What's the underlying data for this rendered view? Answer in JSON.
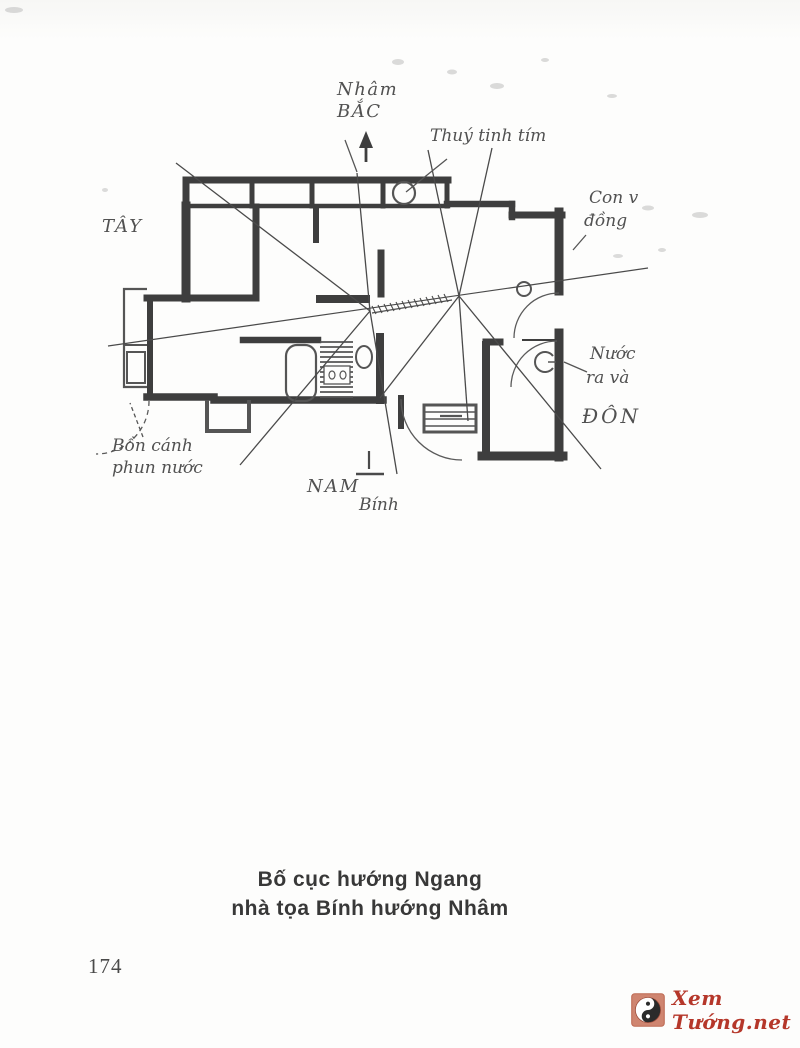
{
  "page": {
    "number": "174"
  },
  "caption": {
    "line1": "Bố cục hướng Ngang",
    "line2": "nhà tọa Bính hướng Nhâm"
  },
  "diagram": {
    "compass": {
      "north_heaven": "Nhâm",
      "north": "BẮC",
      "west": "TÂY",
      "east": "ĐÔN",
      "south": "NAM",
      "south_seat": "Bính"
    },
    "annotations": {
      "crystal": "Thuý tinh tím",
      "right_object_line1": "Con v",
      "right_object_line2": "đồng",
      "water_line1": "Nước",
      "water_line2": "ra và",
      "fountain_line1": "Bồn cánh",
      "fountain_line2": "phun nước"
    }
  },
  "watermark": {
    "site": "Xem Tướng.net",
    "icon": "yin-yang",
    "text_color": "#b5372a",
    "icon_bg": "#cf8570",
    "ink_color": "#3e3e3e"
  }
}
